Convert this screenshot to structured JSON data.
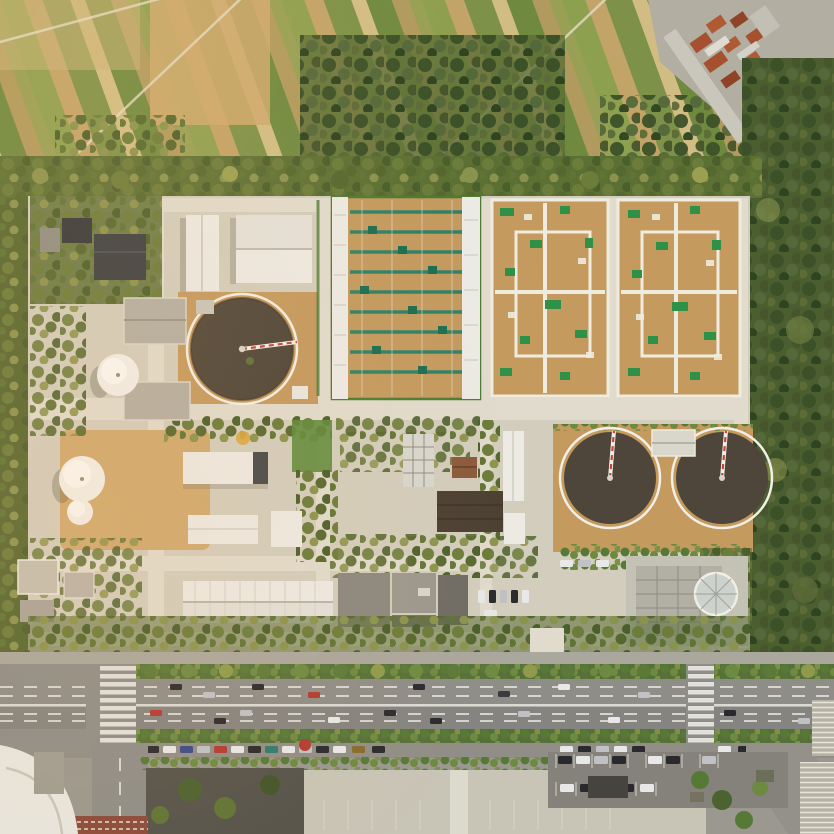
{
  "scene": {
    "type": "aerial-photograph",
    "subject": "wastewater treatment plant seen straight down from above, bordered by farmland to the north, woodland to the east and a multi-lane arterial road to the south",
    "lighting": "warm late-afternoon sunlight from the east, long soft shadows",
    "orientation": "orthographic top-down"
  },
  "palette": {
    "field_green": "#7d9148",
    "field_tan": "#c2a368",
    "field_light": "#d1bd84",
    "field_brown": "#8f7443",
    "tree_olive": "#6b7c3b",
    "tree_dark": "#41582c",
    "woodland": "#4a5e30",
    "concrete": "#d2cdbd",
    "concrete_light": "#e0dbcd",
    "roof_white": "#eceae4",
    "roof_gray": "#9a968c",
    "roof_dark": "#34373a",
    "roof_brown": "#4a3f33",
    "gravel_tan": "#c49a5f",
    "dirt_tan": "#cfa96f",
    "basin_teal": "#2a8068",
    "lawn_green": "#5e8a3c",
    "hedge_green": "#55703a",
    "tank_water": "#4e463a",
    "tank_rim": "#f2efe8",
    "dome_white": "#f1efe9",
    "road_gray": "#8e8d88",
    "road_dark": "#858480",
    "lane_white": "#e8e7e2",
    "plaza": "#c8c4b6",
    "red_roof": "#a5502f",
    "bridge_red": "#c04838",
    "median_green": "#57703a"
  },
  "landmarks": {
    "farmland": "striped crop fields across the top band",
    "village": "cluster of red-tile-roof houses in the top-right corner",
    "east_woodland": "dense tree belt running down the right edge",
    "perimeter_trees": "row of trees separating farmland from the plant",
    "clarifiers": "three dark circular settling tanks with white rims and radial scraper bridges",
    "domes": "three white spherical gas-holder domes on the west side",
    "aeration_complex": "large rectangular basin with teal-green walkway grid on tan cover",
    "membrane_complexes": "two square tan-gravel basins with white walkway grids and green planting",
    "arterial_road": "eight-lane east-west road with tree-planted medians along the bottom",
    "south_parking": "parking lots, plaza and small buildings south of the road"
  },
  "counts": {
    "circular_clarifiers": 3,
    "white_domes": 3,
    "rectangular_basin_complexes": 3,
    "road_median_strips": 2,
    "pedestrian_crossings": 2
  }
}
